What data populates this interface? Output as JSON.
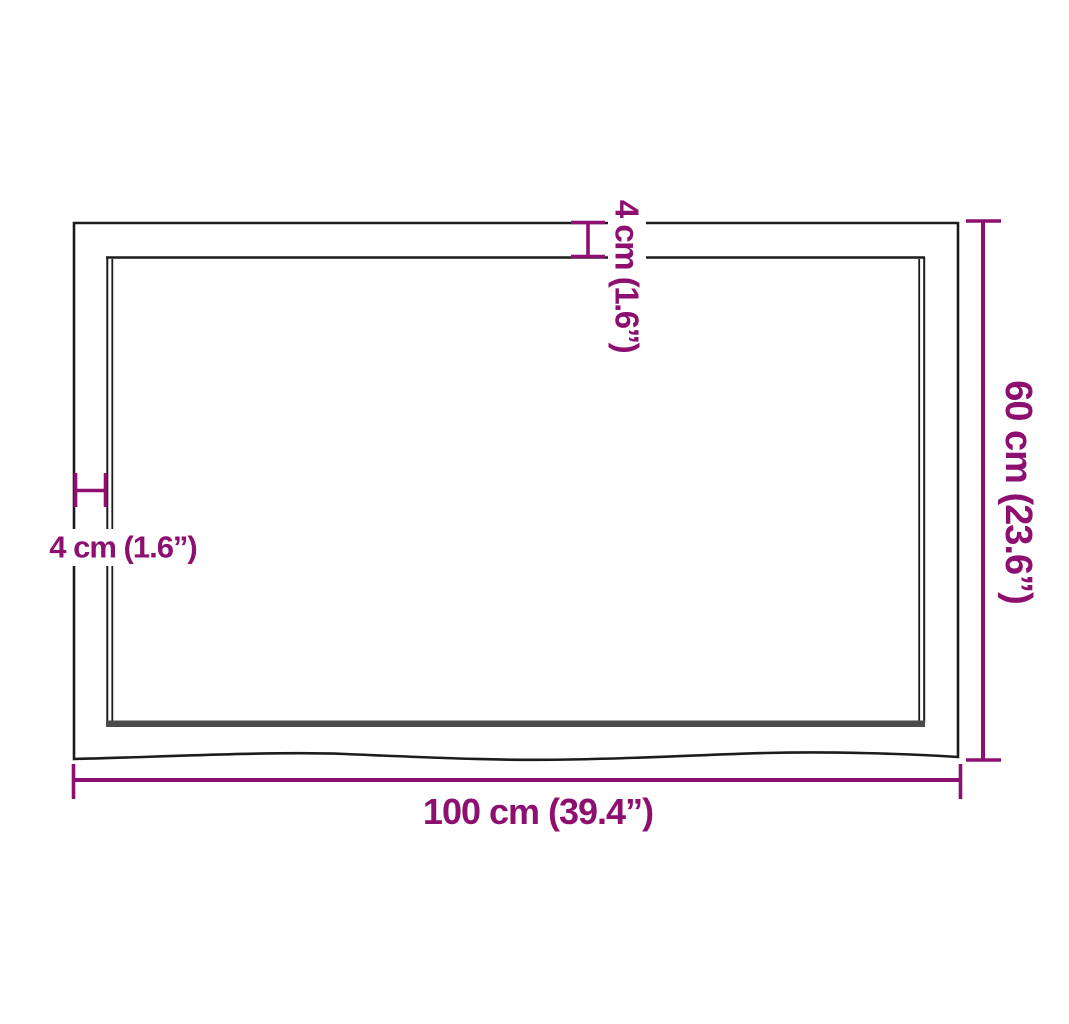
{
  "diagram": {
    "labels": {
      "bottom_width": "100 cm (39.4”)",
      "right_height": "60 cm (23.6”)",
      "left_thickness": "4 cm (1.6”)",
      "top_thickness": "4 cm (1.6”)"
    },
    "colors": {
      "dimension_accent": "#8D1070",
      "outline": "#1C1C1C",
      "edge_shadow": "#4B4B4B",
      "background": "#FFFFFF"
    }
  }
}
